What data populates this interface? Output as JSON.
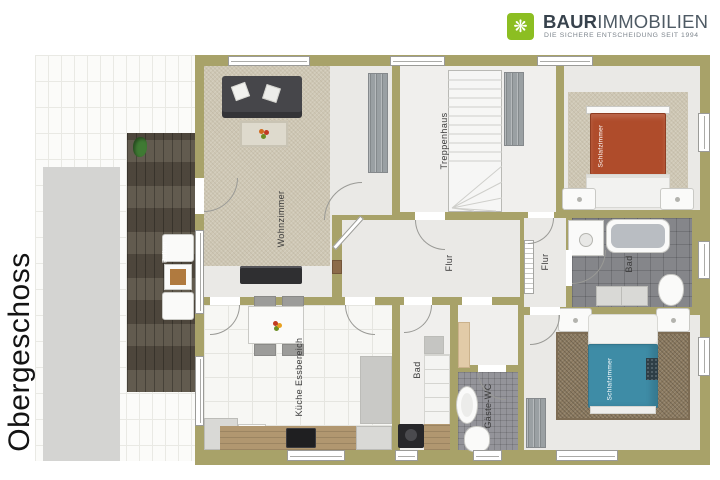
{
  "brand": {
    "word_bold": "BAUR",
    "word_light": "IMMOBILIEN",
    "tagline": "DIE SICHERE ENTSCHEIDUNG SEIT 1994",
    "logo_icon": "crossed-keys-ornament",
    "logo_glyph": "❋",
    "logo_color": "#8cbe22"
  },
  "floor": {
    "label": "Obergeschoss"
  },
  "rooms": {
    "wohnzimmer": {
      "label": "Wohnzimmer"
    },
    "treppenhaus": {
      "label": "Treppenhaus"
    },
    "flur_main": {
      "label": "Flur"
    },
    "flur_right": {
      "label": "Flur"
    },
    "bad_main": {
      "label": "Bad"
    },
    "bad_klein": {
      "label": "Bad"
    },
    "gaeste_wc": {
      "label": "Gäste-WC"
    },
    "kueche": {
      "label": "Küche Essbereich"
    },
    "schlafzimmer_oben": {
      "label": "Schlafzimmer"
    },
    "schlafzimmer_unten": {
      "label": "Schlafzimmer"
    },
    "balkon": {
      "label": "Balkon"
    }
  },
  "colors": {
    "wall": "#a8a269",
    "floor_light": "#eae9e6",
    "carpet_beige": "#cec7b4",
    "balcony_wood": "#5a5246",
    "bath_tile": "#85868a",
    "wc_tile": "#94949a",
    "bed_red": "#af4c2b",
    "bed_blue": "#3e8ca6",
    "rug_brown": "#8b7a60",
    "logo_green": "#8cbe22"
  }
}
